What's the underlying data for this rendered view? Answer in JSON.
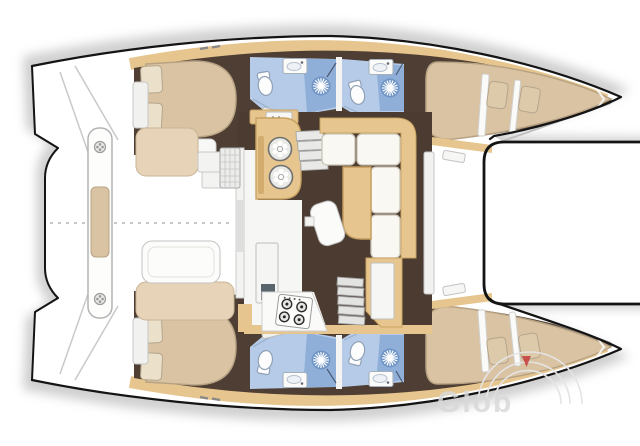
{
  "canvas": {
    "width": 640,
    "height": 446
  },
  "watermark": {
    "text": "Glob",
    "triangle_color": "#c43c3c",
    "arc_color": "#e4e4e4",
    "text_color": "#d9d9d9"
  },
  "palette": {
    "background": "#ffffff",
    "hull-outline": "#141414",
    "sand": "#e6c68e",
    "sand-dark": "#c9a263",
    "floor-brown": "#4b3b31",
    "hull-brown": "#4e3e33",
    "mattress": "#d9c3a2",
    "mattress-edge": "#b7a384",
    "pillow": "#ebe0ca",
    "bath-blue": "#b5cbe8",
    "shower-blue": "#8fafd9",
    "fixture-white": "#fdfdfd",
    "line-gray": "#9e9e9e",
    "wm-gray": "#d9d9d9",
    "wm-red": "#c43c3c",
    "shadow": "#a0a0a0"
  },
  "floorplan": {
    "vessel": "catamaran sailing yacht layout, plan view, bows to the right",
    "port_hull": [
      "aft double cabin with island bed and two pillows",
      "bathroom with toilet, washbasin and shower",
      "second bathroom with toilet, washbasin and shower",
      "forward double berth with two pillows"
    ],
    "starboard_hull": [
      "aft double cabin with island bed and two pillows",
      "bathroom with toilet, washbasin and shower",
      "second bathroom with toilet, washbasin and shower",
      "forward double berth with two pillows"
    ],
    "saloon": [
      "galley block with twin round sinks",
      "overhead galley cabinet with appliance",
      "fridge unit",
      "four-burner stove on worktop",
      "L-shaped sofa",
      "saloon table",
      "stool",
      "chart cabinet",
      "companionway stairs to port hull",
      "companionway stairs to starboard hull"
    ],
    "cockpit": [
      "aft bench with cushion and two winches",
      "port cockpit seat",
      "starboard cockpit seat",
      "cockpit table",
      "grill side table",
      "entry steps"
    ],
    "foredeck": [
      "trampoline between the bows"
    ]
  },
  "icons": {
    "shower-icon": "sunburst on blue circle",
    "toilet-icon": "oval bowl with tank",
    "sink-icon": "rectangular basin with tap dot",
    "round-sink-icon": "ringed circle with petals",
    "burner-icon": "ringed circle with center dot",
    "winch-icon": "flower bolt circle"
  }
}
